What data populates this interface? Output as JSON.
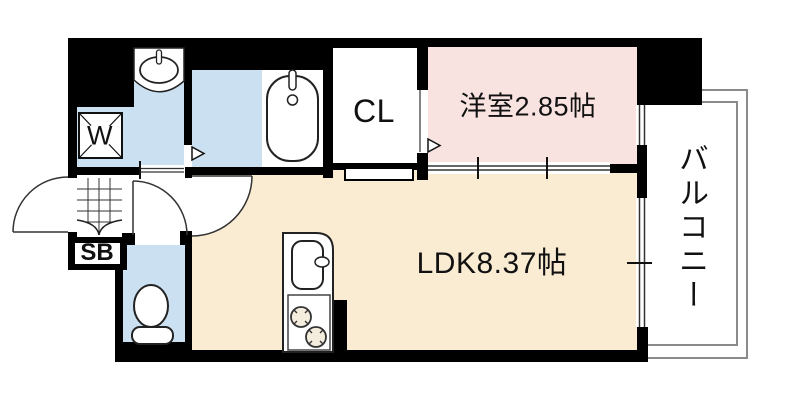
{
  "plan": {
    "labels": {
      "ldk": "LDK8.37帖",
      "western_room": "洋室2.85帖",
      "closet": "CL",
      "balcony": "バルコニー",
      "washing_machine": "W",
      "shoe_box": "SB"
    },
    "colors": {
      "wall": "#000000",
      "wet_area": "#CBE1F2",
      "ldk_floor": "#FAECD3",
      "western_room_floor": "#F8E3E0",
      "white": "#FFFFFF",
      "balcony_line": "#8A8A8A",
      "fixture_outline": "#222222"
    }
  }
}
